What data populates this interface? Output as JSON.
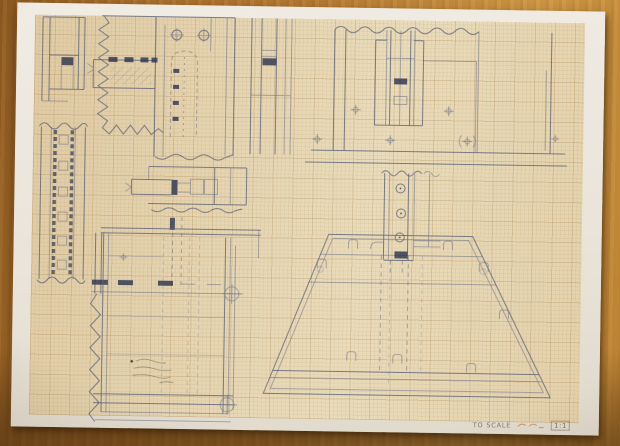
{
  "title_block": {
    "note": "TO SCALE",
    "scale": "1:1"
  },
  "sheet": {
    "type": "graph-paper",
    "orientation": "landscape"
  },
  "colors": {
    "wood": "#b27a33",
    "paper_margin": "#eae4da",
    "grid_paper": "#e6d8b6",
    "pencil_line": "#5d6378",
    "ink_dark": "#2f3652",
    "orange_note": "#c8763a"
  },
  "views": [
    {
      "id": "corner-channel-section",
      "kind": "section-strip"
    },
    {
      "id": "post-ladder-section",
      "kind": "section-strip"
    },
    {
      "id": "corner-joint-detail",
      "kind": "detail-with-slot-and-holes"
    },
    {
      "id": "narrow-section-strip",
      "kind": "section-strip"
    },
    {
      "id": "post-in-base-elevation",
      "kind": "elevation"
    },
    {
      "id": "tenon-joint-detail",
      "kind": "detail"
    },
    {
      "id": "assembly-plan",
      "kind": "plan-with-datum-targets"
    },
    {
      "id": "plinth-base",
      "kind": "trapezoid-base"
    },
    {
      "id": "drilled-post",
      "kind": "elevation"
    }
  ]
}
